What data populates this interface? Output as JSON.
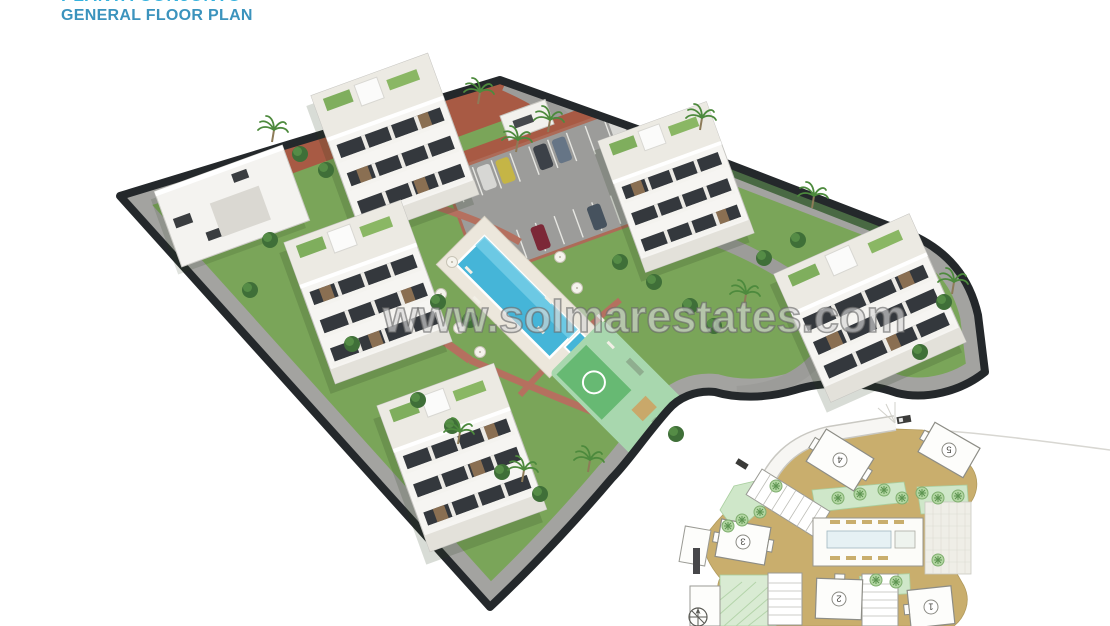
{
  "header": {
    "title_line1": "PLANTA CONJUNTO",
    "title_line2": "GENERAL FLOOR PLAN"
  },
  "watermark": {
    "text": "www.solmarestates.com"
  },
  "scene": {
    "description": "3D aerial rendering of a residential complex with five white apartment buildings, clubhouse, parking lot, central swimming pool, kids pool, playground and landscaped gardens inside a dark-edged plot",
    "apartment_building_count": 5
  },
  "inset_plan": {
    "description": "2D general site plan (rotated 180 degrees) at bottom right with numbered buildings",
    "buildings": [
      {
        "label": "1"
      },
      {
        "label": "2"
      },
      {
        "label": "3"
      },
      {
        "label": "4"
      },
      {
        "label": "5"
      }
    ]
  },
  "palette": {
    "title_cyan": "#35b2de",
    "title_blue": "#3b93bd",
    "lawn_green": "#7aa559",
    "boundary_dark": "#24282b",
    "road_gray": "#a3a3a0",
    "pool_blue": "#45b5d8",
    "playground_mint": "#a8d7ae",
    "brick_red": "#a85a44",
    "inset_ground_tan": "#c9ae6d",
    "inset_green": "#cfe7c9",
    "building_white": "#f6f5f2"
  }
}
